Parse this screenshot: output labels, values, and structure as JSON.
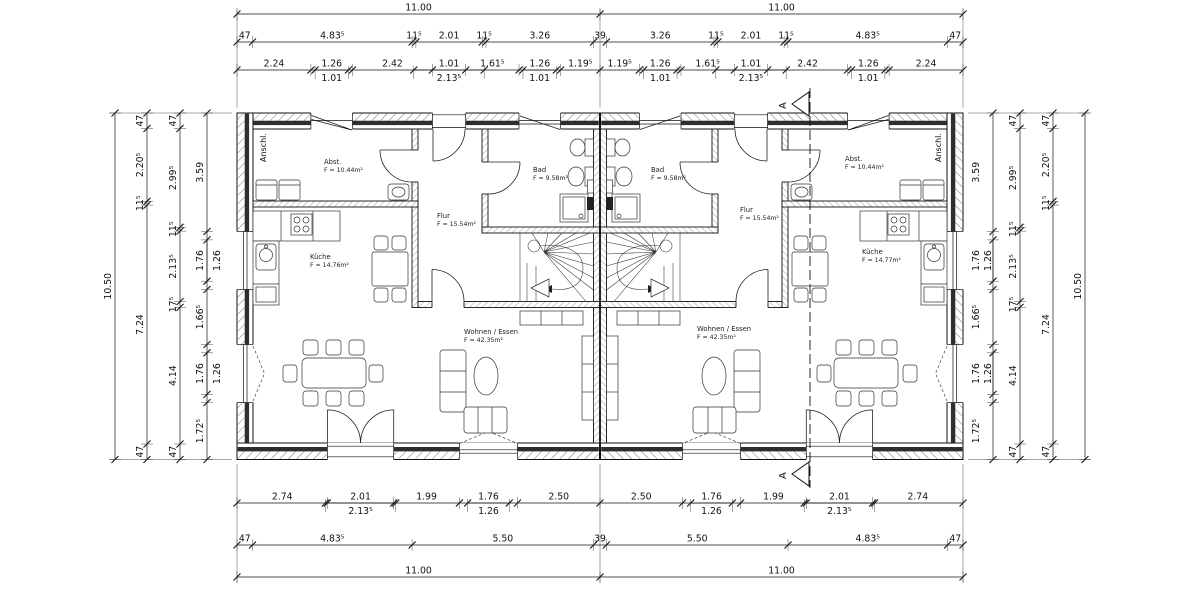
{
  "rooms": [
    {
      "name": "Abst.",
      "area": "F = 10.44m²",
      "x": 324,
      "y": 164
    },
    {
      "name": "Bad",
      "area": "F = 9.58m²",
      "x": 533,
      "y": 172
    },
    {
      "name": "Flur",
      "area": "F = 15.54m²",
      "x": 437,
      "y": 218
    },
    {
      "name": "Küche",
      "area": "F = 14.76m²",
      "x": 310,
      "y": 259
    },
    {
      "name": "Wohnen / Essen",
      "area": "F = 42.35m²",
      "x": 464,
      "y": 334
    },
    {
      "name": "Bad",
      "area": "F = 9.58m²",
      "x": 651,
      "y": 172
    },
    {
      "name": "Flur",
      "area": "F = 15.54m²",
      "x": 740,
      "y": 212
    },
    {
      "name": "Abst.",
      "area": "F = 10.44m²",
      "x": 845,
      "y": 161
    },
    {
      "name": "Küche",
      "area": "F = 14.77m²",
      "x": 862,
      "y": 254
    },
    {
      "name": "Wohnen / Essen",
      "area": "F = 42.35m²",
      "x": 697,
      "y": 331
    }
  ],
  "annotations": [
    {
      "text": "Anschl.",
      "x": 266,
      "y": 162,
      "size": 8
    },
    {
      "text": "Anschl.",
      "x": 941,
      "y": 162,
      "size": 8
    },
    {
      "text": "A",
      "x": 786,
      "y": 109,
      "size": 10
    },
    {
      "text": "A",
      "x": 786,
      "y": 479,
      "size": 10
    }
  ],
  "dims": {
    "h_chains": [
      {
        "y": 14,
        "ticks": [
          237,
          600,
          963
        ],
        "labels": [
          "11.00",
          "11.00"
        ]
      },
      {
        "y": 42,
        "ticks": [
          237,
          252.5,
          412.1,
          415.9,
          482.2,
          486,
          593.6,
          606.4,
          714,
          717.8,
          784.1,
          787.9,
          947.5,
          963
        ],
        "labels": [
          "47",
          "4.83⁵",
          "11⁵",
          "2.01",
          "11⁵",
          "3.26",
          "39",
          "3.26",
          "11⁵",
          "2.01",
          "11⁵",
          "4.83⁵",
          "47"
        ]
      },
      {
        "y": 70,
        "ticks": [
          237,
          310.9,
          352.5,
          432.4,
          465.7,
          519,
          560.6,
          600,
          639.4,
          681,
          734.3,
          767.6,
          847.5,
          889.1,
          963
        ],
        "labels": [
          "2.24",
          "1.26",
          "2.42",
          "1.01",
          "1.61⁵",
          "1.26",
          "1.19⁵",
          "1.19⁵",
          "1.26",
          "1.61⁵",
          "1.01",
          "2.42",
          "1.26",
          "2.24"
        ]
      },
      {
        "y": 70,
        "sub": true,
        "ticks": [
          315.1,
          348.4
        ],
        "labels": [
          "1.01"
        ]
      },
      {
        "y": 70,
        "sub": true,
        "ticks": [
          413.8,
          484.2
        ],
        "labels": [
          "2.13⁵"
        ]
      },
      {
        "y": 70,
        "sub": true,
        "ticks": [
          523,
          556.3
        ],
        "labels": [
          "1.01"
        ]
      },
      {
        "y": 70,
        "sub": true,
        "ticks": [
          643.7,
          677
        ],
        "labels": [
          "1.01"
        ]
      },
      {
        "y": 70,
        "sub": true,
        "ticks": [
          715.8,
          786.2
        ],
        "labels": [
          "2.13⁵"
        ]
      },
      {
        "y": 70,
        "sub": true,
        "ticks": [
          851.6,
          884.9
        ],
        "labels": [
          "1.01"
        ]
      },
      {
        "y": 503,
        "ticks": [
          237,
          327.4,
          393.7,
          459.4,
          517.5,
          600,
          682.5,
          740.6,
          806.3,
          872.6,
          963
        ],
        "labels": [
          "2.74",
          "2.01",
          "1.99",
          "1.76",
          "2.50",
          "2.50",
          "1.76",
          "1.99",
          "2.01",
          "2.74"
        ]
      },
      {
        "y": 503,
        "sub": true,
        "ticks": [
          325.4,
          395.8
        ],
        "labels": [
          "2.13⁵"
        ]
      },
      {
        "y": 503,
        "sub": true,
        "ticks": [
          467.7,
          509.3
        ],
        "labels": [
          "1.26"
        ]
      },
      {
        "y": 503,
        "sub": true,
        "ticks": [
          690.7,
          732.3
        ],
        "labels": [
          "1.26"
        ]
      },
      {
        "y": 503,
        "sub": true,
        "ticks": [
          804.2,
          874.6
        ],
        "labels": [
          "2.13⁵"
        ]
      },
      {
        "y": 545,
        "ticks": [
          237,
          252.5,
          412.1,
          593.6,
          606.4,
          788,
          947.5,
          963
        ],
        "labels": [
          "47",
          "4.83⁵",
          "5.50",
          "39",
          "5.50",
          "4.83⁵",
          "47"
        ]
      },
      {
        "y": 577,
        "ticks": [
          237,
          600,
          963
        ],
        "labels": [
          "11.00",
          "11.00"
        ]
      }
    ],
    "v_chains": [
      {
        "x": 115,
        "tdx": -4,
        "ticks": [
          113,
          459.5
        ],
        "labels": [
          "10.50"
        ]
      },
      {
        "x": 147,
        "tdx": -4,
        "ticks": [
          113,
          128.5,
          201.3,
          205.1,
          444,
          459.5
        ],
        "labels": [
          "47",
          "2.20⁵",
          "11⁵",
          "7.24",
          "47"
        ]
      },
      {
        "x": 180,
        "tdx": -4,
        "ticks": [
          113,
          128.5,
          227.3,
          231.1,
          301.6,
          307.4,
          444,
          459.5
        ],
        "labels": [
          "47",
          "2.99⁵",
          "11⁵",
          "2.13⁵",
          "17⁵",
          "4.14",
          "47"
        ]
      },
      {
        "x": 207,
        "tdx": -4,
        "ticks": [
          113,
          231.5,
          289.5,
          344.5,
          402.6,
          459.5
        ],
        "labels": [
          "3.59",
          "1.76",
          "1.66⁵",
          "1.76",
          "1.72⁵"
        ]
      },
      {
        "x": 207,
        "tdx": 13,
        "sub": true,
        "ticks": [
          239.9,
          281.2
        ],
        "labels": [
          "1.26"
        ]
      },
      {
        "x": 207,
        "tdx": 13,
        "sub": true,
        "ticks": [
          352.8,
          394.4
        ],
        "labels": [
          "1.26"
        ]
      },
      {
        "x": 993,
        "tdx": -14,
        "ticks": [
          113,
          231.5,
          289.5,
          344.5,
          402.6,
          459.5
        ],
        "labels": [
          "3.59",
          "1.76",
          "1.66⁵",
          "1.76",
          "1.72⁵"
        ]
      },
      {
        "x": 993,
        "tdx": -2,
        "sub": true,
        "ticks": [
          239.9,
          281.2
        ],
        "labels": [
          "1.26"
        ]
      },
      {
        "x": 993,
        "tdx": -2,
        "sub": true,
        "ticks": [
          352.8,
          394.4
        ],
        "labels": [
          "1.26"
        ]
      },
      {
        "x": 1020,
        "tdx": -4,
        "ticks": [
          113,
          128.5,
          227.3,
          231.1,
          301.6,
          307.4,
          444,
          459.5
        ],
        "labels": [
          "47",
          "2.99⁵",
          "11⁵",
          "2.13⁵",
          "17⁵",
          "4.14",
          "47"
        ]
      },
      {
        "x": 1053,
        "tdx": -4,
        "ticks": [
          113,
          128.5,
          201.3,
          205.1,
          444,
          459.5
        ],
        "labels": [
          "47",
          "2.20⁵",
          "11⁵",
          "7.24",
          "47"
        ]
      },
      {
        "x": 1085,
        "tdx": -4,
        "ticks": [
          113,
          459.5
        ],
        "labels": [
          "10.50"
        ]
      }
    ]
  },
  "section": {
    "letter": "A"
  }
}
